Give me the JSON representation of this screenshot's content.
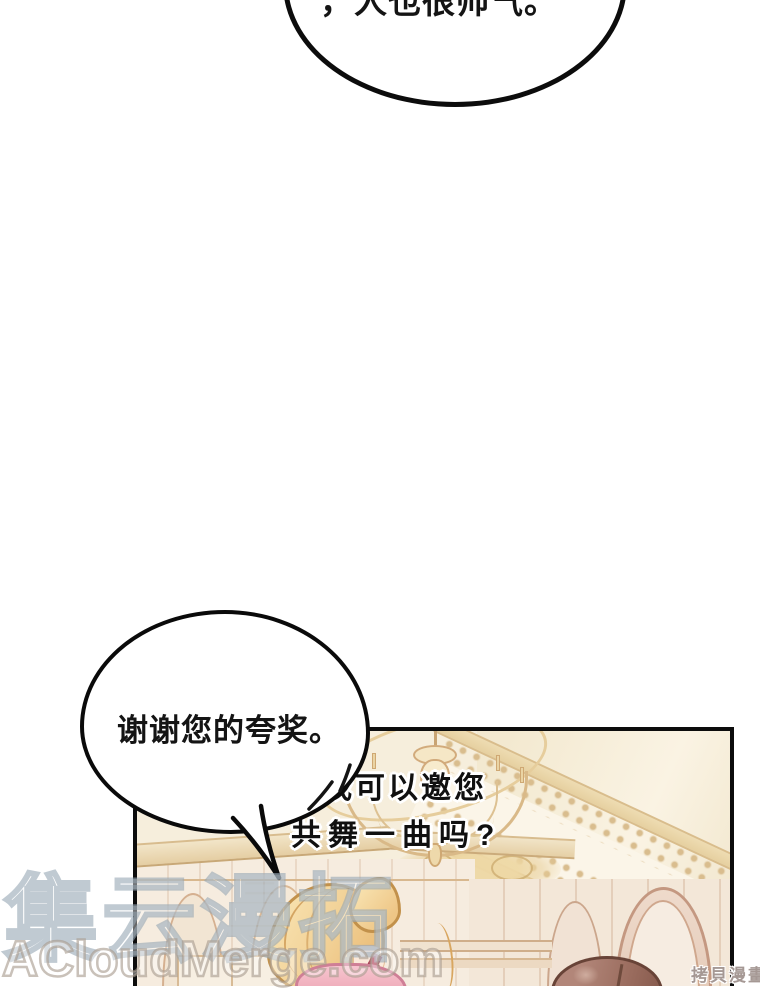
{
  "dialogue": {
    "top_bubble_text": "，人也很帅气。",
    "thanks_bubble_text": "谢谢您的夸奖。",
    "ask_line1": "那我可以邀您",
    "ask_line2": "共舞一曲吗?"
  },
  "watermarks": {
    "brand_cn": "集云漫拓",
    "brand_url": "ACloudMerge.com",
    "corner_mark": "拷貝漫畫"
  },
  "scene": {
    "colors": {
      "ceiling_cream": "#f6eedc",
      "beam_tan": "#e9d5a9",
      "lace_tan": "#d9bd8e",
      "wall_rose": "#c49881",
      "hair_blonde": "#f1cf93",
      "hair_brown": "#9a6c5e",
      "dress_pink": "#f3bac4",
      "ribbon_red": "#a8394f",
      "outline_black": "#0c0c0c"
    }
  }
}
